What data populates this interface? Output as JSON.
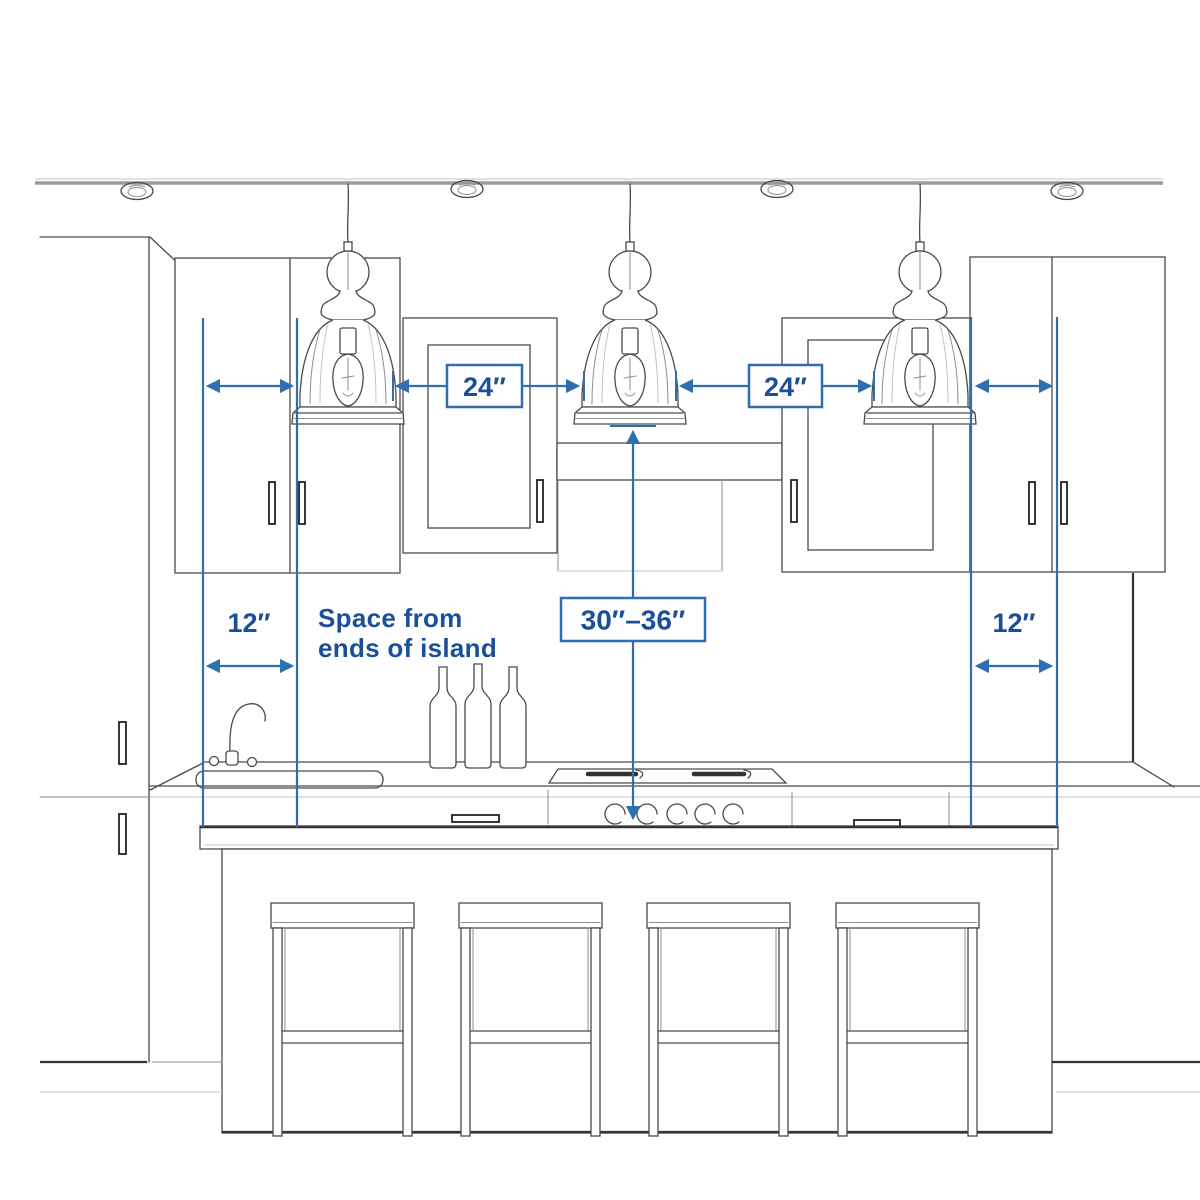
{
  "figure": {
    "pendant_count": 3,
    "bar_stool_count": 4,
    "recessed_ceiling_light_count": 4,
    "wine_bottle_count": 3
  },
  "colors": {
    "dimension_blue": "#2f6fb0",
    "label_blue": "#1b4f99",
    "sketch_dark": "#4a4a4a",
    "sketch_light": "#8f8f8f",
    "background": "#ffffff"
  },
  "labels": {
    "pendant_spacing_left": "24″",
    "pendant_spacing_right": "24″",
    "island_end_space_left": "12″",
    "island_end_space_right": "12″",
    "height_above_island": "30″–36″",
    "note_line1": "Space from",
    "note_line2": "ends of island"
  }
}
